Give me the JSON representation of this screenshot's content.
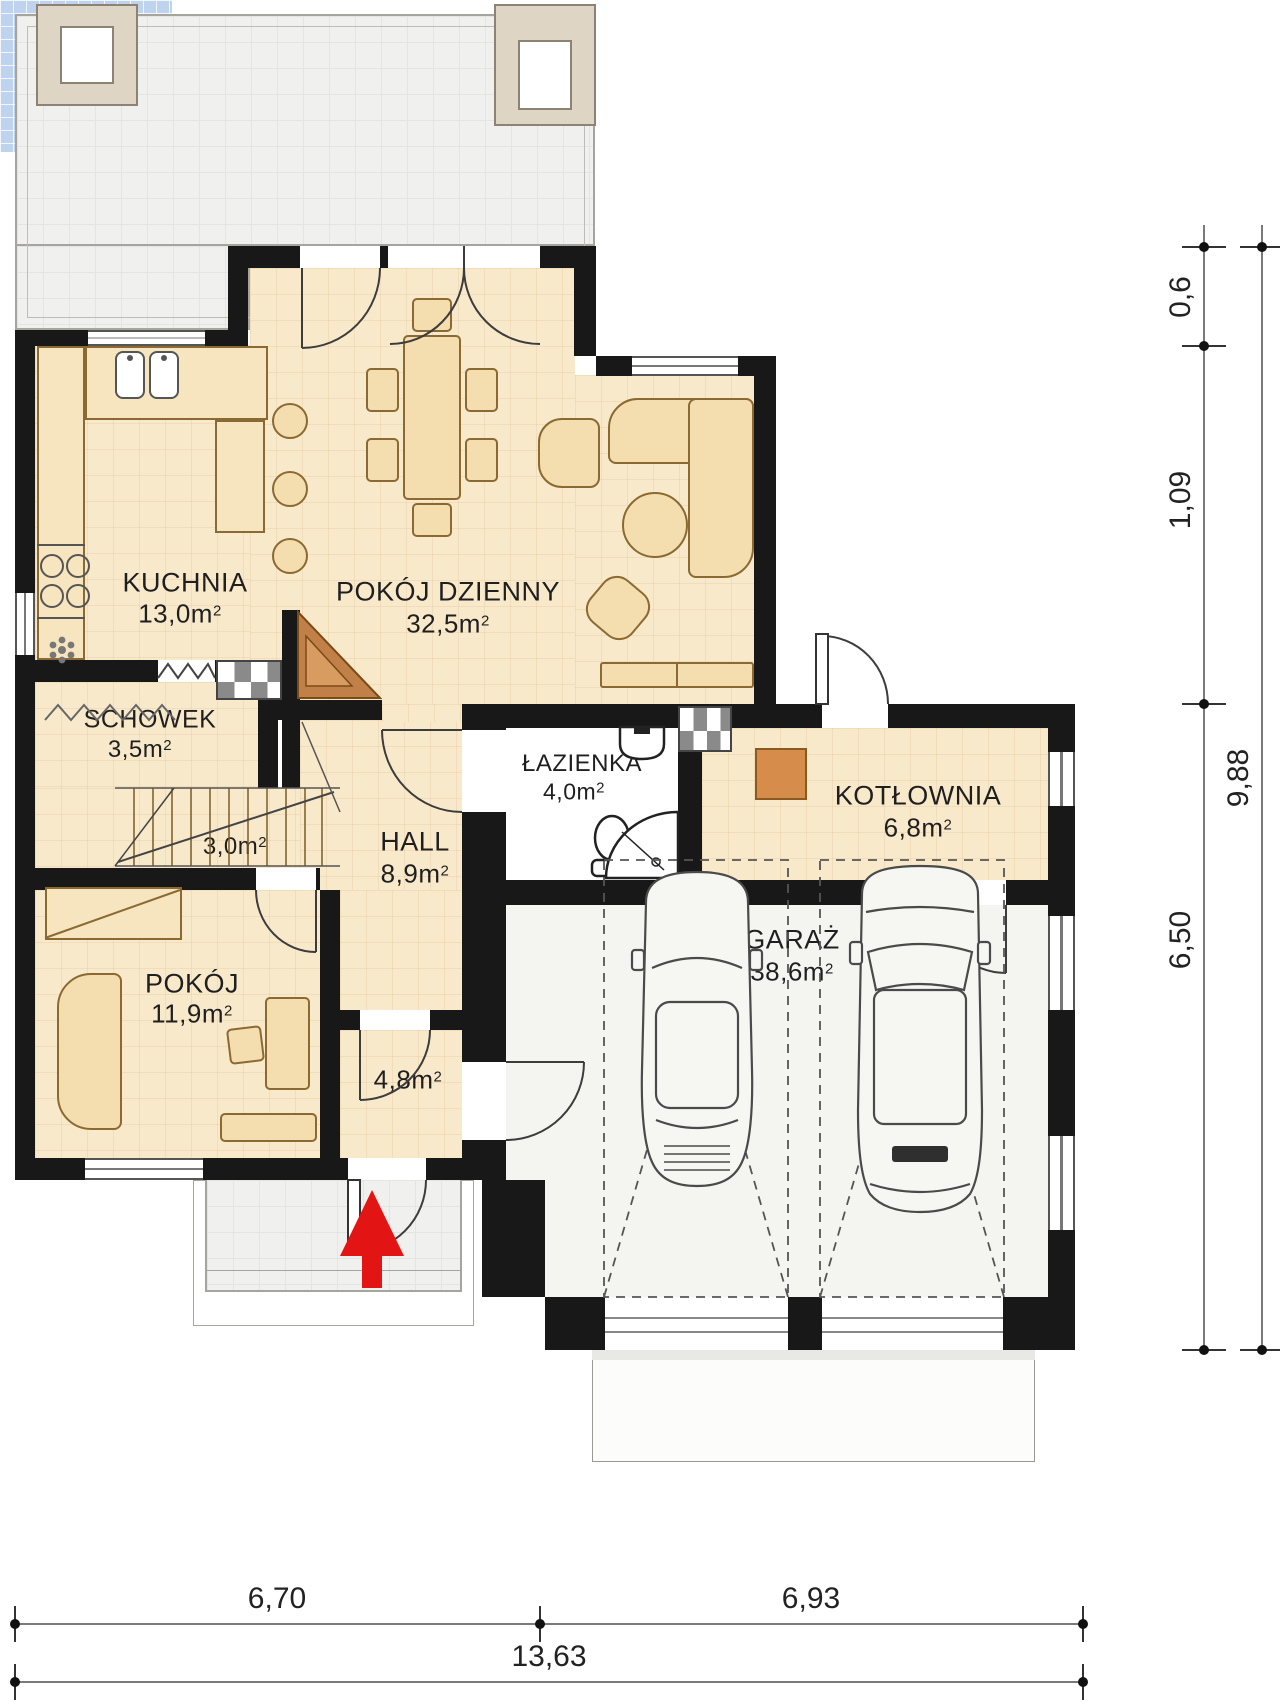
{
  "rooms": {
    "kuchnia": {
      "label": "KUCHNIA",
      "area": "13,0m",
      "sup": "2"
    },
    "pokoj_dzienny": {
      "label": "POKÓJ DZIENNY",
      "area": "32,5m",
      "sup": "2"
    },
    "schowek": {
      "label": "SCHOWEK",
      "area": "3,5m",
      "sup": "2"
    },
    "schody": {
      "label": "",
      "area": "3,0m",
      "sup": "2"
    },
    "hall": {
      "label": "HALL",
      "area": "8,9m",
      "sup": "2"
    },
    "lazienka": {
      "label": "ŁAZIENKA",
      "area": "4,0m",
      "sup": "2"
    },
    "kotlownia": {
      "label": "KOTŁOWNIA",
      "area": "6,8m",
      "sup": "2"
    },
    "garaz": {
      "label": "GARAŻ",
      "area": "38,6m",
      "sup": "2"
    },
    "pokoj": {
      "label": "POKÓJ",
      "area": "11,9m",
      "sup": "2"
    },
    "wiatrolap": {
      "label": "",
      "area": "4,8m",
      "sup": "2"
    }
  },
  "dimensions": {
    "right": [
      "0,6",
      "1,09",
      "6,50",
      "9,88"
    ],
    "bottom": [
      "6,70",
      "6,93",
      "13,63"
    ]
  },
  "colors": {
    "wall": "#181818",
    "room_floor": "#f9e9cb",
    "bath_floor": "#bdd3ee",
    "paving": "#f0f0ee",
    "furniture": "#f4ddae",
    "fireplace": "#c08048",
    "boiler": "#d68c4a",
    "entrance_arrow": "#e21414"
  }
}
